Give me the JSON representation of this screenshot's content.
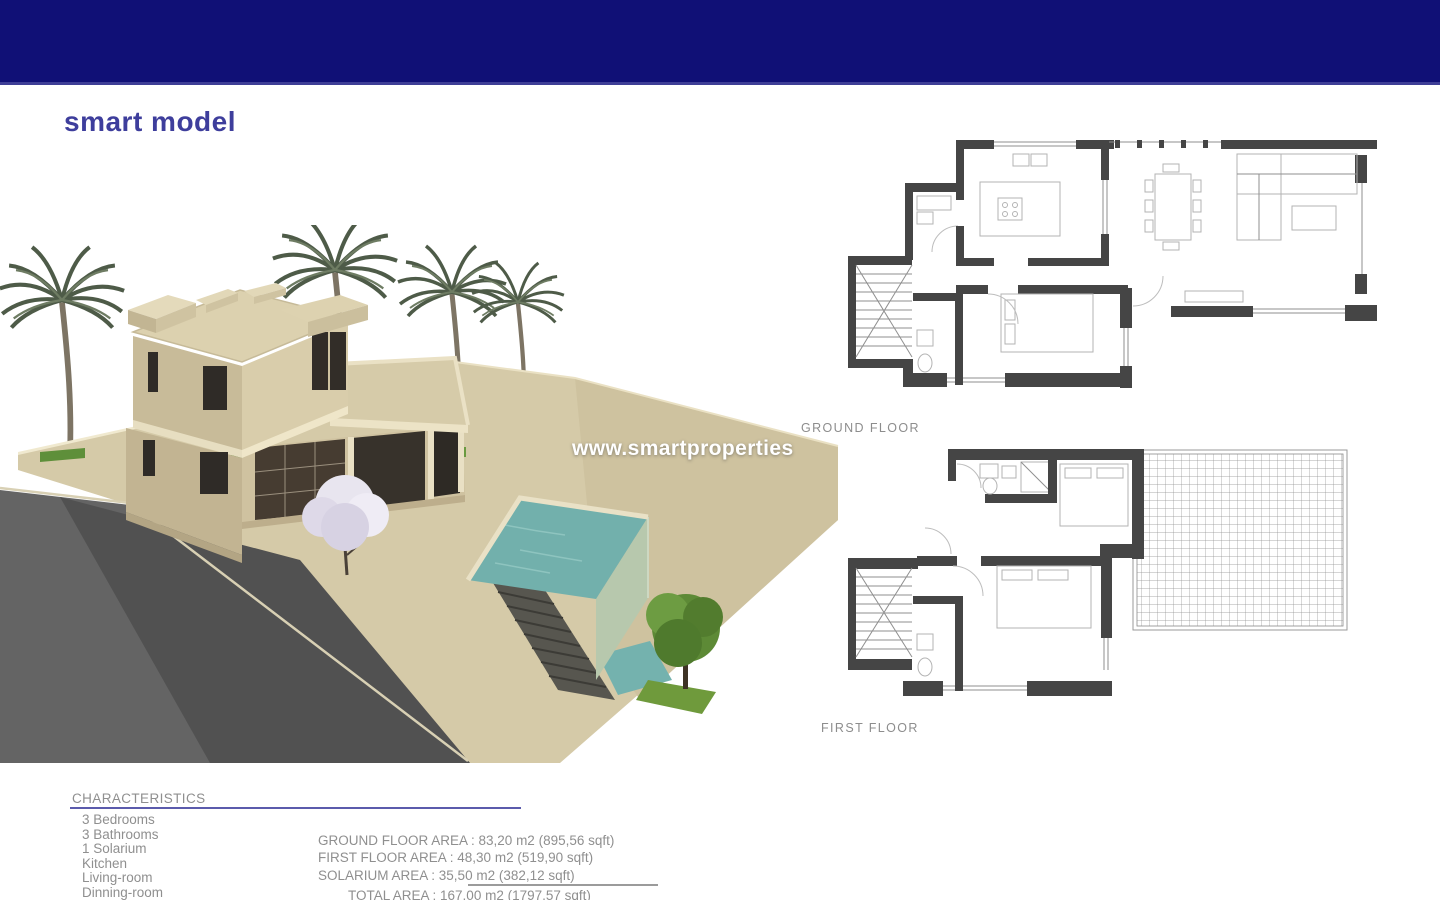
{
  "brand": {
    "logo_text": "smart model",
    "logo_color": "#3e3e9c"
  },
  "watermark": {
    "text": "www.smartproperties"
  },
  "floor_plans": {
    "ground_label": "GROUND FLOOR",
    "first_label": "FIRST FLOOR"
  },
  "characteristics": {
    "title": "CHARACTERISTICS",
    "rooms": [
      "3 Bedrooms",
      "3 Bathrooms",
      "1 Solarium",
      "Kitchen",
      "Living-room",
      "Dinning-room"
    ],
    "areas": [
      "GROUND FLOOR AREA : 83,20 m2 (895,56 sqft)",
      "FIRST FLOOR AREA : 48,30 m2 (519,90 sqft)",
      "SOLARIUM AREA : 35,50 m2 (382,12 sqft)"
    ],
    "total": "TOTAL AREA : 167,00 m2 (1797,57 sqft)"
  },
  "colors": {
    "header_navy": "#101076",
    "accent_underline": "#5b5bac",
    "text_gray": "#8f8f8f",
    "plan_wall": "#454545",
    "pool_water": "#72b0ac",
    "render_beige": "#d5caa8"
  }
}
